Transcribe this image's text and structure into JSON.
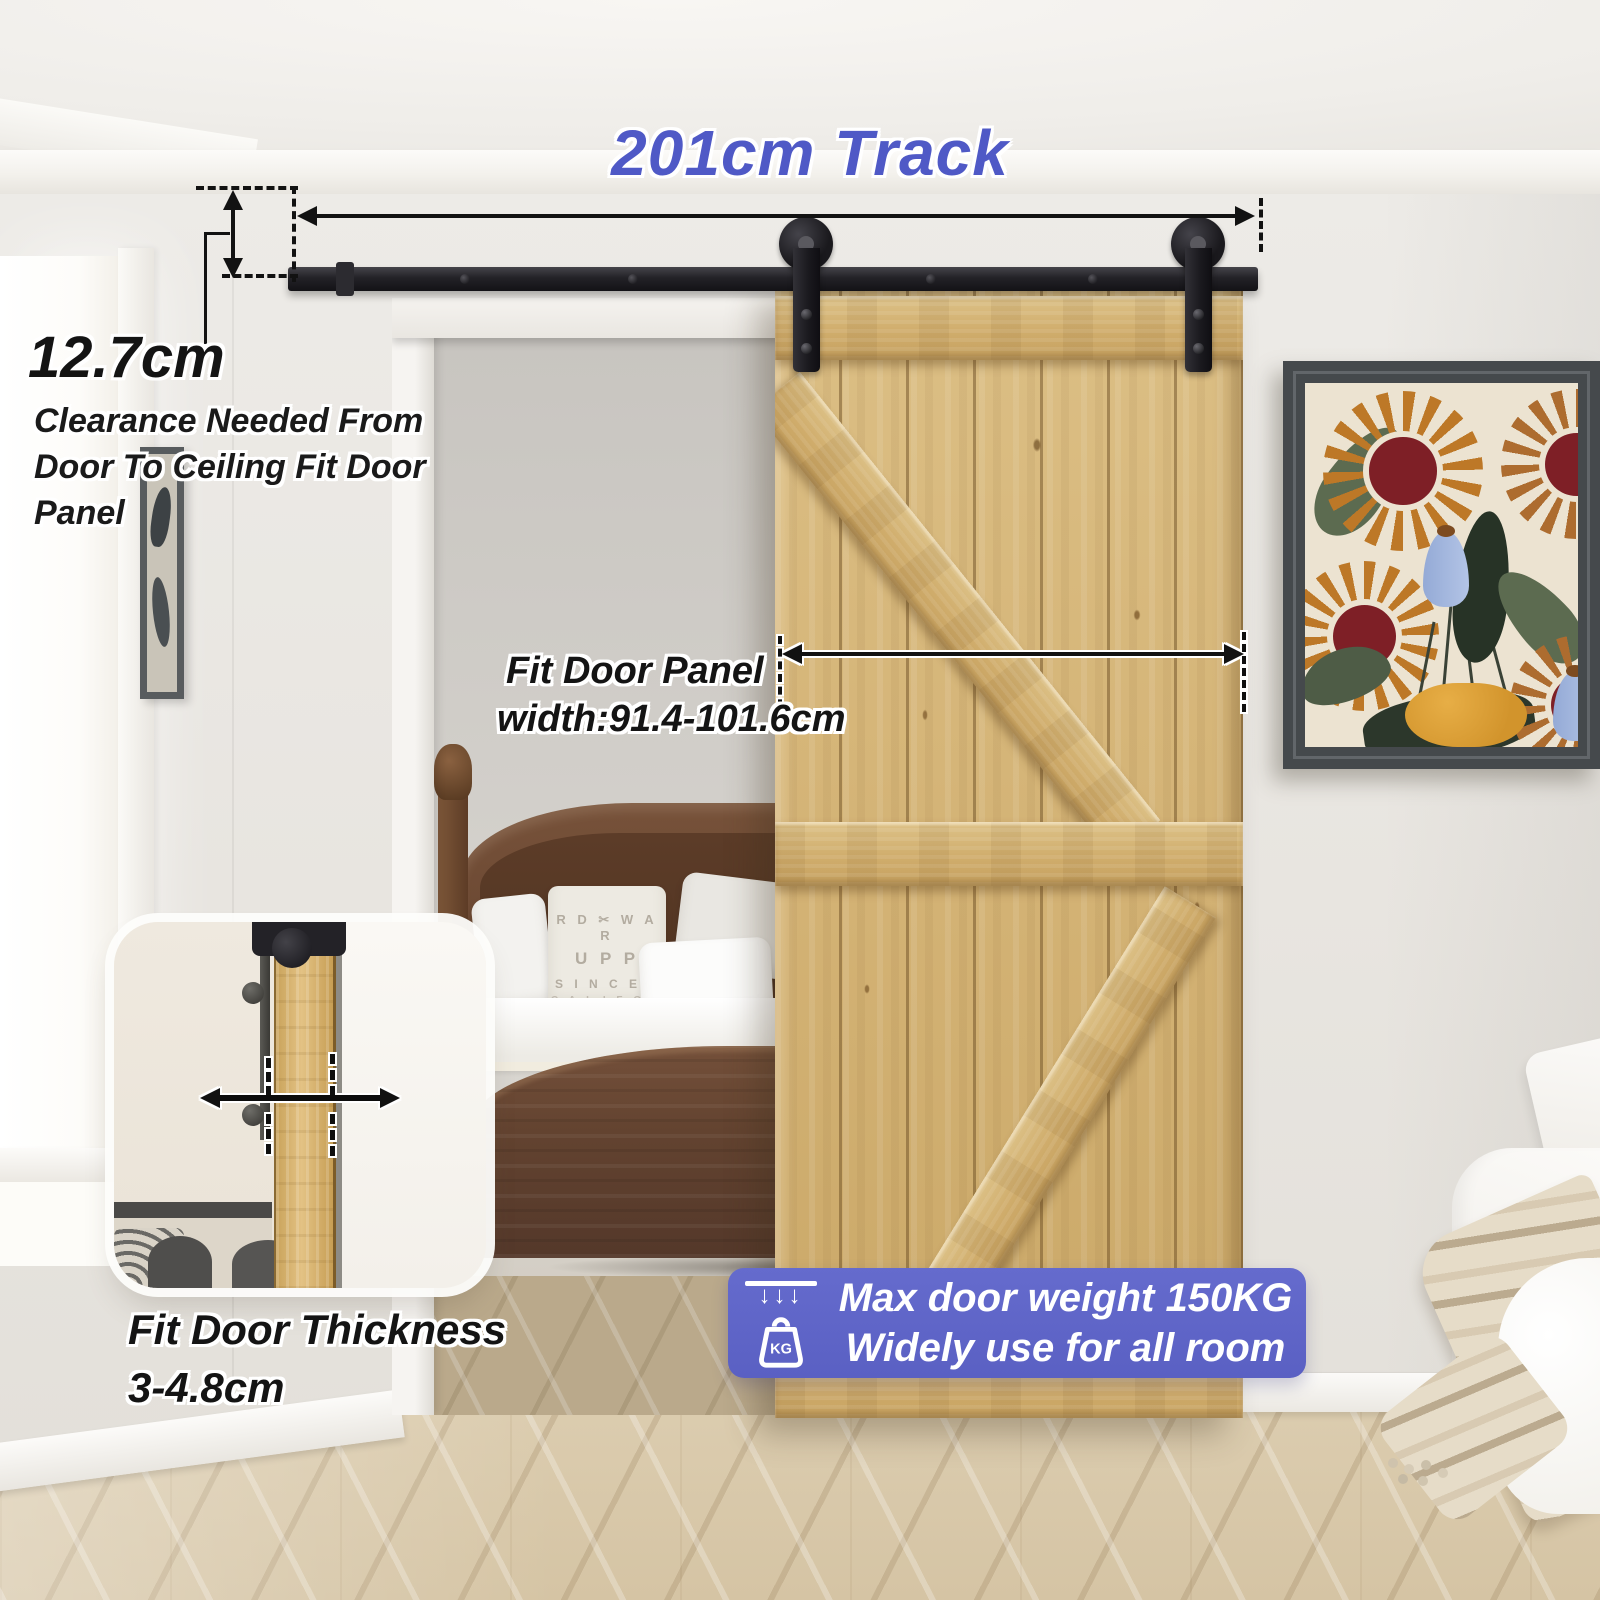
{
  "annotations": {
    "track_label": "201cm Track",
    "clearance_value": "12.7cm",
    "clearance_lines": [
      "Clearance Needed From",
      "Door To Ceiling Fit Door",
      "Panel"
    ],
    "panel_line1": "Fit Door Panel",
    "panel_line2": "width:91.4-101.6cm",
    "thickness_line1": "Fit Door Thickness",
    "thickness_line2": "3-4.8cm"
  },
  "badge": {
    "line1": "Max door weight 150KG",
    "line2": "Widely use for all room",
    "kg_label": "KG",
    "arrows_glyph": "↓↓↓",
    "bg_color": "#5e64c7"
  },
  "scene": {
    "pillow_print_lines": [
      "R D ✂ W A R",
      "U P P",
      "S I N C E 1",
      "C A L I F O R"
    ]
  },
  "colors": {
    "accent_blue": "#4f59c6",
    "annotation_black": "#141414",
    "door_wood": "#d5b67c",
    "track_black": "#1f1e22",
    "floor_wood": "#dbcbad",
    "wall": "#eae7e2"
  }
}
